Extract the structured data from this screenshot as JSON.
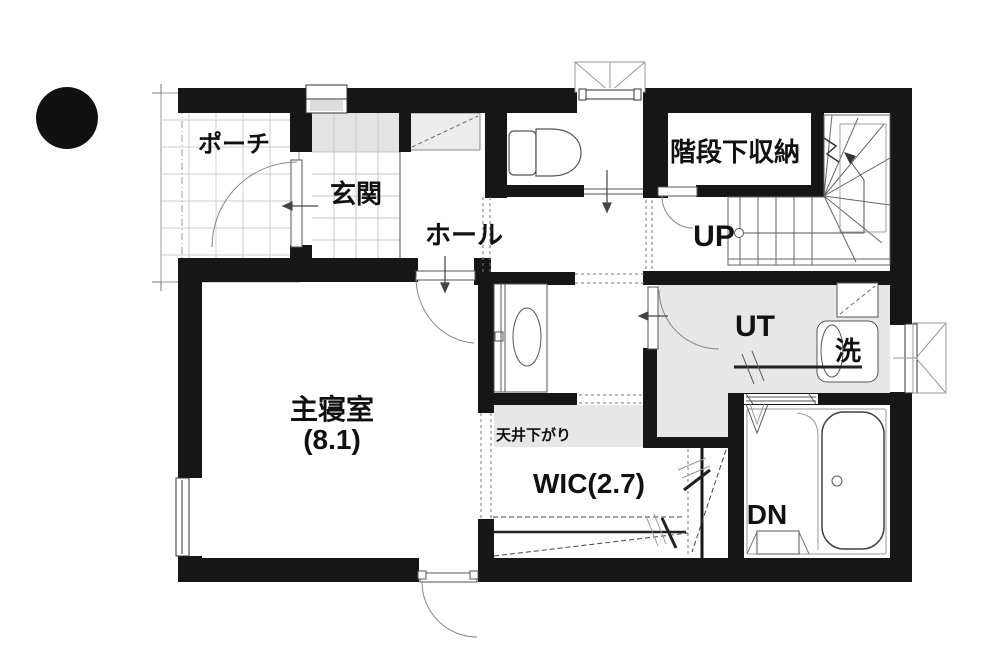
{
  "badge": {
    "floor_number": "1",
    "floor_letter": "F"
  },
  "labels": {
    "porch": "ポーチ",
    "entrance": "玄関",
    "hall": "ホール",
    "under_stair_storage": "階段下収納",
    "up": "UP",
    "utility": "UT",
    "laundry": "洗",
    "master_bedroom": "主寝室",
    "master_bedroom_area": "(8.1)",
    "ceiling_drop": "天井下がり",
    "wic": "WIC(2.7)",
    "dn": "DN"
  },
  "colors": {
    "wall": "#161616",
    "floor_gray": "#e7e7e7",
    "tile_line": "#cccccc",
    "fixture_line": "#555555",
    "background": "#ffffff"
  }
}
